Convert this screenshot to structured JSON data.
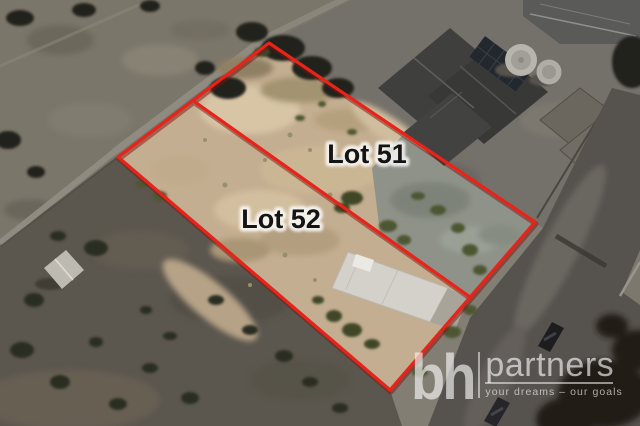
{
  "image": {
    "description": "Aerial drone photo of two vacant land lots outlined in red beside a house and road"
  },
  "lots": [
    {
      "label": "Lot 51"
    },
    {
      "label": "Lot 52"
    }
  ],
  "watermark": {
    "brand_bold": "bh",
    "brand_light": "partners",
    "tagline": "your dreams – our goals"
  },
  "colors": {
    "boundary_red": "#e8231a",
    "boundary_shadow": "#7f150e",
    "lot_soil_tan": "#c4ae91",
    "label_text": "#141414",
    "label_halo": "#ffffff",
    "watermark_white": "#f6f6f6"
  }
}
